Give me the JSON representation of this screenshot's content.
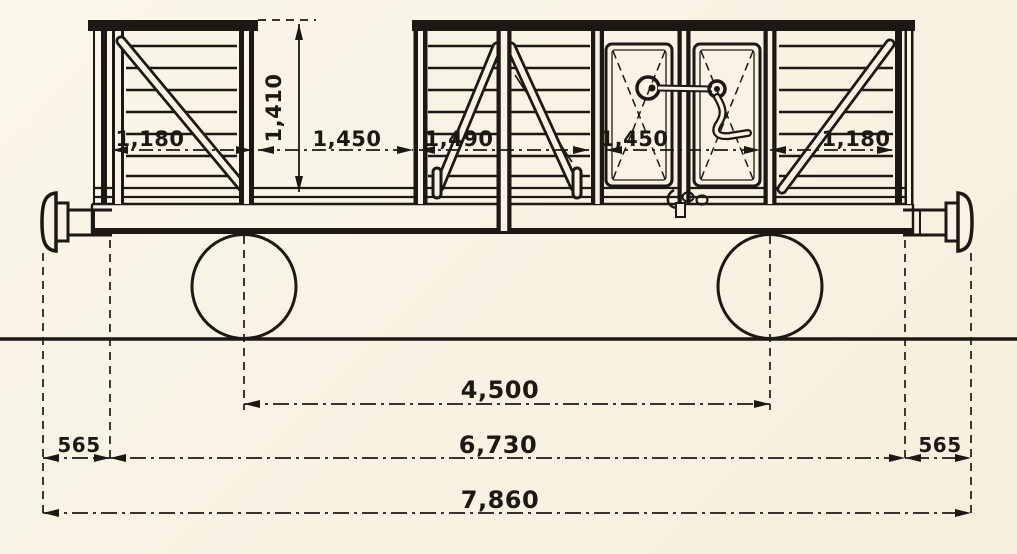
{
  "drawing": {
    "subject": "Side elevation technical drawing of a four-wheel slatted railway goods wagon with centre double doors, chained dimensions in millimetres",
    "unit": "mm",
    "colors": {
      "paper": "#f8f3e5",
      "ink": "#1d1813"
    },
    "dims": {
      "side_height": "1,410",
      "end_panel_left": "1,180",
      "opening_left": "1,450",
      "middle_panel": "1,490",
      "door_opening": "1,450",
      "end_panel_right": "1,180",
      "wheelbase": "4,500",
      "overhang_left": "565",
      "body_length": "6,730",
      "overhang_right": "565",
      "overall_length": "7,860"
    }
  }
}
